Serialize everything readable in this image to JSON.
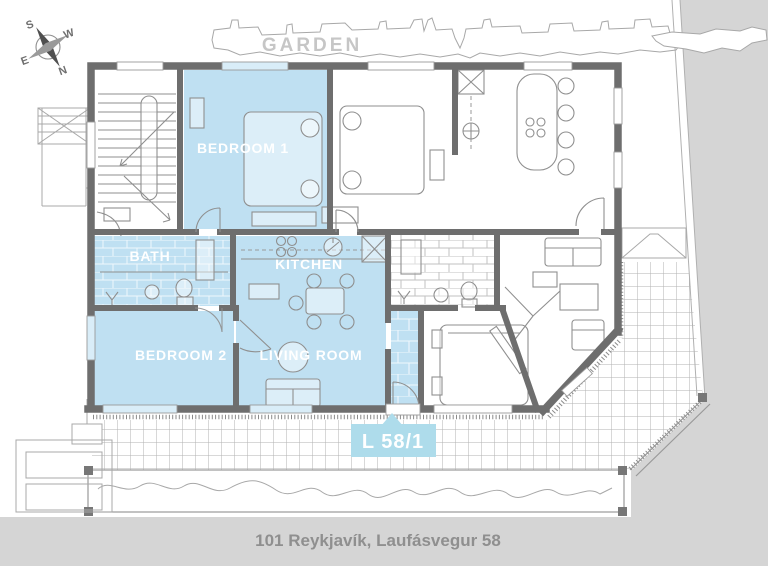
{
  "plan": {
    "caption": "101 Reykjavík, Laufásvegur 58",
    "garden_label": "GARDEN",
    "unit_label": "L 58/1"
  },
  "compass": {
    "north": "N",
    "south": "S",
    "east": "E",
    "west": "W"
  },
  "rooms": {
    "bedroom1": "BEDROOM 1",
    "bath": "BATH",
    "kitchen": "KITCHEN",
    "bedroom2": "BEDROOM 2",
    "living_room": "LIVING ROOM"
  },
  "colors": {
    "highlight": "#bfe0f2",
    "badge": "#aedceb",
    "wall": "#6e6e6e",
    "line": "#9a9a9a",
    "background": "#d5d5d5",
    "paper": "#ffffff",
    "room_label": "#ffffff",
    "garden_text": "#c6c6c6",
    "caption_text": "#8f8f8f"
  }
}
